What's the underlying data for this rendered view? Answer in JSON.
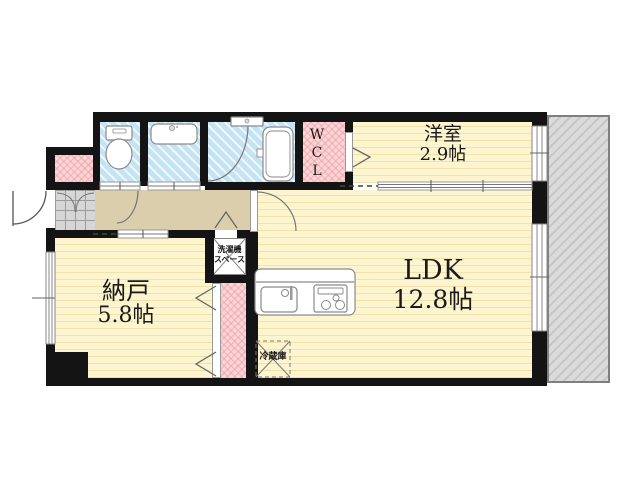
{
  "floorplan": {
    "rooms": {
      "western_room": {
        "name": "洋室",
        "size": "2.9帖"
      },
      "ldk": {
        "name": "LDK",
        "size": "12.8帖"
      },
      "storage_room": {
        "name": "納戸",
        "size": "5.8帖"
      },
      "walk_in_closet": {
        "l1": "W",
        "l2": "C",
        "l3": "L"
      },
      "laundry_space": {
        "line1": "洗濯機",
        "line2": "スペース"
      },
      "refrigerator": {
        "label": "冷蔵庫"
      }
    },
    "colors": {
      "room_yellow": "#fcf5d0",
      "yellow_stripe": "#e6ce86",
      "wet_area_blue": "#c3e4f4",
      "closet_pink": "#fbd6d8",
      "hallway_tan": "#dbcead",
      "entrance_tile_gray": "#d6d6d6",
      "balcony_hatch_gray": "#dbdbdb",
      "wall_black": "#141414"
    }
  }
}
